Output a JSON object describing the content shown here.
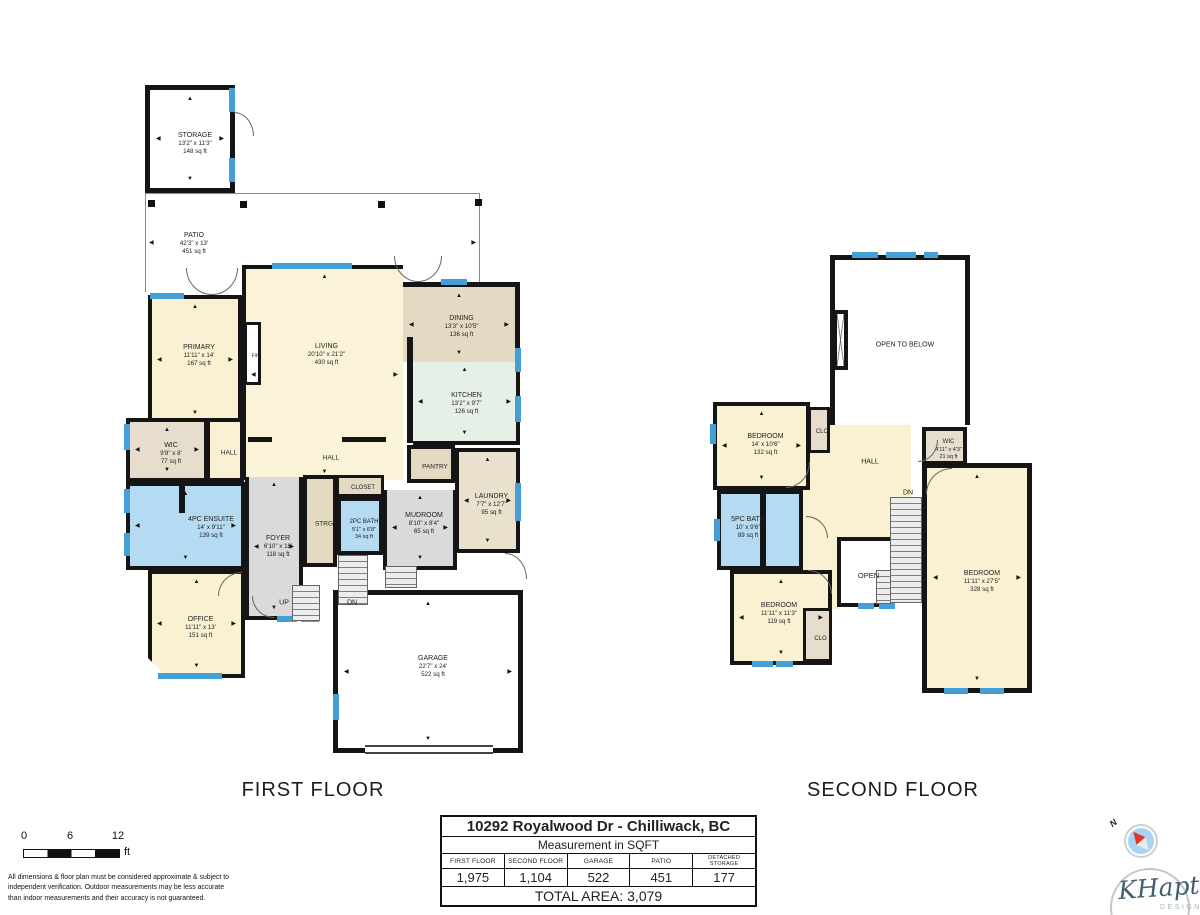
{
  "colors": {
    "wall": "#151515",
    "window": "#43A0D7",
    "cream": "#FAF0D2",
    "blue": "#B5DBF2",
    "gray": "#DADADA",
    "tan": "#E4DAC3",
    "mint": "#E7F0E7"
  },
  "floors": [
    {
      "title": "FIRST FLOOR",
      "title_x": 313,
      "title_y": 779,
      "rooms": [
        {
          "n": "PATIO",
          "d": "42'3\" x 13'",
          "a": "451 sq ft",
          "x": 145,
          "y": 193,
          "w": 335,
          "h": 99,
          "cls": "patio",
          "lx": 193,
          "ly": 243,
          "ar": "lr"
        },
        {
          "n": "LIVING",
          "d": "20'10\" x 21'2\"",
          "a": "430 sq ft",
          "x": 242,
          "y": 265,
          "w": 161,
          "h": 215,
          "f": "#FBF3D8",
          "b": 4,
          "bs": "lt",
          "ly": 351,
          "ar": "all"
        },
        {
          "n": "DINING",
          "d": "13'3\" x 10'5\"",
          "a": "136 sq ft",
          "x": 403,
          "y": 282,
          "w": 117,
          "h": 80,
          "f": "#E4DAC3",
          "b": 5,
          "bs": "tr",
          "ar": "all"
        },
        {
          "n": "KITCHEN",
          "d": "13'2\" x 9'7\"",
          "a": "126 sq ft",
          "x": 413,
          "y": 362,
          "w": 107,
          "h": 83,
          "f": "#E7F0E7",
          "b": 4,
          "bs": "rb",
          "ar": "all"
        },
        {
          "n": "PRIMARY",
          "d": "11'11\" x 14'",
          "a": "167 sq ft",
          "x": 148,
          "y": 295,
          "w": 94,
          "h": 130,
          "f": "#FAF0D2",
          "b": 4,
          "ly": 352,
          "ar": "all"
        },
        {
          "n": "WIC",
          "d": "9'8\" x 8'",
          "a": "77 sq ft",
          "x": 126,
          "y": 418,
          "w": 82,
          "h": 64,
          "f": "#E6DDCD",
          "b": 4,
          "ar": "all"
        },
        {
          "n": "HALL",
          "x": 206,
          "y": 418,
          "w": 38,
          "h": 64,
          "f": "#FAF0D2",
          "b": 4,
          "fs": 6.5
        },
        {
          "n": "F/P",
          "x": 244,
          "y": 322,
          "w": 17,
          "h": 63,
          "f": "#FFFFFF",
          "b": 3,
          "fs": 5
        },
        {
          "n": "PANTRY",
          "x": 407,
          "y": 445,
          "w": 48,
          "h": 38,
          "f": "#E4DAC3",
          "b": 4,
          "fs": 6.5
        },
        {
          "n": "LAUNDRY",
          "d": "7'7\" x 12'7\"",
          "a": "95 sq ft",
          "x": 455,
          "y": 448,
          "w": 65,
          "h": 105,
          "f": "#E9E0CE",
          "b": 4,
          "ar": "all"
        },
        {
          "n": "CLOSET",
          "x": 336,
          "y": 475,
          "w": 48,
          "h": 22,
          "f": "#E4DAC3",
          "b": 3,
          "fs": 6
        },
        {
          "n": "STRG",
          "x": 303,
          "y": 475,
          "w": 34,
          "h": 92,
          "f": "#E4DAC3",
          "b": 4,
          "fs": 6.5
        },
        {
          "n": "2PC BATH",
          "d": "5'1\" x 6'8\"",
          "a": "34 sq ft",
          "x": 337,
          "y": 497,
          "w": 46,
          "h": 58,
          "f": "#B5DBF2",
          "b": 4,
          "fs": 6,
          "dfs": 5.5
        },
        {
          "n": "MUDROOM",
          "d": "8'10\" x 8'4\"",
          "a": "65 sq ft",
          "x": 383,
          "y": 490,
          "w": 74,
          "h": 80,
          "f": "#DADADA",
          "b": 4,
          "bs": "lrb",
          "ly": 524,
          "ar": "all"
        },
        {
          "n": "4PC ENSUITE",
          "d": "14' x 9'11\"",
          "a": "139 sq ft",
          "x": 126,
          "y": 482,
          "w": 119,
          "h": 88,
          "f": "#B5DBF2",
          "b": 4,
          "lx": 207,
          "ly": 524,
          "ar": "all"
        },
        {
          "n": "FOYER",
          "d": "6'10\" x 18'",
          "a": "118 sq ft",
          "x": 245,
          "y": 477,
          "w": 58,
          "h": 143,
          "f": "#DADADA",
          "b": 4,
          "bs": "lrb",
          "ly": 547,
          "ar": "all"
        },
        {
          "n": "OFFICE",
          "d": "11'11\" x 13'",
          "a": "151 sq ft",
          "x": 148,
          "y": 570,
          "w": 97,
          "h": 108,
          "f": "#FAF0D2",
          "b": 4,
          "cls": "bevel",
          "ar": "all"
        },
        {
          "n": "GARAGE",
          "d": "22'7\" x 24'",
          "a": "522 sq ft",
          "x": 333,
          "y": 590,
          "w": 190,
          "h": 163,
          "f": "#FFFFFF",
          "b": 5,
          "ly": 662,
          "ar": "all"
        },
        {
          "n": "STORAGE",
          "d": "13'2\" x 11'3\"",
          "a": "148 sq ft",
          "x": 145,
          "y": 85,
          "w": 90,
          "h": 108,
          "f": "#FFFFFF",
          "b": 5,
          "ar": "all"
        }
      ],
      "labels": [
        {
          "t": "HALL",
          "x": 331,
          "y": 458,
          "fs": 6.5
        },
        {
          "t": "UP",
          "x": 284,
          "y": 603,
          "fs": 7
        },
        {
          "t": "DN",
          "x": 352,
          "y": 603,
          "fs": 7
        }
      ],
      "windows": [
        [
          229,
          88,
          6,
          24
        ],
        [
          229,
          158,
          6,
          24
        ],
        [
          150,
          293,
          34,
          6
        ],
        [
          272,
          263,
          80,
          6
        ],
        [
          441,
          279,
          26,
          6
        ],
        [
          515,
          348,
          6,
          24
        ],
        [
          515,
          396,
          6,
          26
        ],
        [
          515,
          483,
          6,
          38
        ],
        [
          124,
          424,
          6,
          26
        ],
        [
          124,
          489,
          6,
          24
        ],
        [
          124,
          533,
          6,
          23
        ],
        [
          158,
          673,
          64,
          6
        ],
        [
          333,
          694,
          6,
          26
        ],
        [
          277,
          616,
          20,
          6
        ],
        [
          301,
          616,
          18,
          6
        ]
      ],
      "walls": [
        [
          407,
          337,
          6,
          106
        ],
        [
          248,
          437,
          24,
          5
        ],
        [
          342,
          437,
          44,
          5
        ],
        [
          179,
          485,
          6,
          28
        ]
      ],
      "stairs": [
        [
          292,
          585,
          28,
          36
        ],
        [
          338,
          555,
          30,
          50
        ],
        [
          385,
          566,
          32,
          22
        ]
      ],
      "posts": [
        [
          148,
          200
        ],
        [
          240,
          201
        ],
        [
          378,
          201
        ],
        [
          475,
          199
        ]
      ],
      "gdoor": {
        "x": 365,
        "y": 745,
        "w": 128,
        "h": 9
      },
      "arcs": [
        {
          "x": 186,
          "y": 268,
          "w": 26,
          "h": 27,
          "r": "bl",
          "s": "lb"
        },
        {
          "x": 212,
          "y": 268,
          "w": 26,
          "h": 27,
          "r": "br",
          "s": "rb"
        },
        {
          "x": 394,
          "y": 256,
          "w": 24,
          "h": 26,
          "r": "bl",
          "s": "lb"
        },
        {
          "x": 418,
          "y": 256,
          "w": 24,
          "h": 26,
          "r": "br",
          "s": "rb"
        },
        {
          "x": 234,
          "y": 112,
          "w": 20,
          "h": 24,
          "r": "tr",
          "s": "tr"
        },
        {
          "x": 252,
          "y": 596,
          "w": 22,
          "h": 22,
          "r": "bl",
          "s": "lb"
        },
        {
          "x": 505,
          "y": 553,
          "w": 22,
          "h": 26,
          "r": "tr",
          "s": "tr"
        },
        {
          "x": 218,
          "y": 572,
          "w": 24,
          "h": 24,
          "r": "tl",
          "s": "lt"
        }
      ]
    },
    {
      "title": "SECOND FLOOR",
      "title_x": 893,
      "title_y": 779,
      "rooms": [
        {
          "n": "",
          "x": 805,
          "y": 425,
          "w": 106,
          "h": 112,
          "f": "#FAF0D2",
          "b": 0
        },
        {
          "n": "",
          "x": 803,
          "y": 490,
          "w": 36,
          "h": 120,
          "f": "#FAF0D2",
          "b": 0
        },
        {
          "n": "OPEN TO BELOW",
          "x": 830,
          "y": 255,
          "w": 140,
          "h": 170,
          "f": "#FFFFFF",
          "b": 5,
          "bs": "ltr",
          "fs": 7
        },
        {
          "n": "",
          "x": 833,
          "y": 310,
          "w": 15,
          "h": 60,
          "cls": "chimney"
        },
        {
          "n": "BEDROOM",
          "d": "14' x 10'6\"",
          "a": "132 sq ft",
          "x": 713,
          "y": 402,
          "w": 97,
          "h": 88,
          "f": "#FAF0D2",
          "b": 4,
          "ly": 441,
          "ar": "all"
        },
        {
          "n": "CLO",
          "x": 808,
          "y": 407,
          "w": 22,
          "h": 46,
          "f": "#E6DDCD",
          "b": 3,
          "fs": 6
        },
        {
          "n": "WIC",
          "d": "4'11\" x 4'3\"",
          "a": "21 sq ft",
          "x": 922,
          "y": 427,
          "w": 45,
          "h": 38,
          "f": "#E6DDCD",
          "b": 4,
          "fs": 6,
          "dfs": 5.5
        },
        {
          "n": "5PC BATH",
          "d": "10' x 9'6\"",
          "a": "89 sq ft",
          "x": 717,
          "y": 490,
          "w": 86,
          "h": 80,
          "f": "#B5DBF2",
          "b": 4,
          "lx": 744,
          "ly": 524
        },
        {
          "n": "BEDROOM",
          "d": "11'11\" x 11'3\"",
          "a": "119 sq ft",
          "x": 730,
          "y": 570,
          "w": 102,
          "h": 95,
          "f": "#FAF0D2",
          "b": 4,
          "lx": 775,
          "ly": 610,
          "ar": "all"
        },
        {
          "n": "CLO",
          "x": 803,
          "y": 608,
          "w": 29,
          "h": 54,
          "f": "#E6DDCD",
          "b": 3,
          "fs": 6,
          "ly": 637
        },
        {
          "n": "OPEN",
          "x": 837,
          "y": 537,
          "w": 55,
          "h": 70,
          "f": "#FFFFFF",
          "b": 4,
          "bs": "ltb",
          "fs": 7.5
        },
        {
          "n": "BEDROOM",
          "d": "11'11\" x 27'5\"",
          "a": "328 sq ft",
          "x": 922,
          "y": 463,
          "w": 110,
          "h": 230,
          "f": "#FAF0D2",
          "b": 5,
          "ly": 577,
          "ar": "all"
        }
      ],
      "labels": [
        {
          "t": "HALL",
          "x": 870,
          "y": 462,
          "fs": 7
        },
        {
          "t": "DN",
          "x": 908,
          "y": 493,
          "fs": 7
        }
      ],
      "windows": [
        [
          852,
          252,
          26,
          6
        ],
        [
          886,
          252,
          30,
          6
        ],
        [
          924,
          252,
          14,
          6
        ],
        [
          710,
          424,
          6,
          20
        ],
        [
          714,
          519,
          6,
          22
        ],
        [
          752,
          661,
          21,
          6
        ],
        [
          776,
          661,
          17,
          6
        ],
        [
          858,
          603,
          16,
          6
        ],
        [
          879,
          603,
          16,
          6
        ],
        [
          944,
          688,
          24,
          6
        ],
        [
          980,
          688,
          24,
          6
        ]
      ],
      "walls": [
        [
          760,
          494,
          6,
          74
        ]
      ],
      "stairs": [
        [
          890,
          497,
          32,
          106
        ],
        [
          876,
          570,
          15,
          34
        ]
      ],
      "posts": [],
      "arcs": [
        {
          "x": 786,
          "y": 462,
          "w": 24,
          "h": 26,
          "r": "br",
          "s": "rb"
        },
        {
          "x": 806,
          "y": 516,
          "w": 22,
          "h": 22,
          "r": "tr",
          "s": "tr"
        },
        {
          "x": 808,
          "y": 570,
          "w": 24,
          "h": 24,
          "r": "tr",
          "s": "tr"
        },
        {
          "x": 926,
          "y": 468,
          "w": 26,
          "h": 26,
          "r": "tl",
          "s": "lt"
        },
        {
          "x": 918,
          "y": 440,
          "w": 20,
          "h": 22,
          "r": "br",
          "s": "rb"
        }
      ]
    }
  ],
  "table": {
    "address": "10292 Royalwood Dr - Chilliwack, BC",
    "subtitle": "Measurement in SQFT",
    "columns": [
      "FIRST FLOOR",
      "SECOND FLOOR",
      "GARAGE",
      "PATIO",
      "DETACHED STORAGE"
    ],
    "values": [
      "1,975",
      "1,104",
      "522",
      "451",
      "177"
    ],
    "total": "TOTAL AREA: 3,079"
  },
  "scalebar": {
    "t0": "0",
    "t6": "6",
    "t12": "12",
    "unit": "ft"
  },
  "footer": {
    "disclaimer": "All dimensions & floor plan must be considered approximate & subject to independent verification.  Outdoor measurements may be less accurate than indoor measurements and their accuracy is not guaranteed."
  },
  "compass": {
    "label": "N"
  },
  "logo": {
    "name": "KHaptive",
    "sub": "DESIGN"
  }
}
